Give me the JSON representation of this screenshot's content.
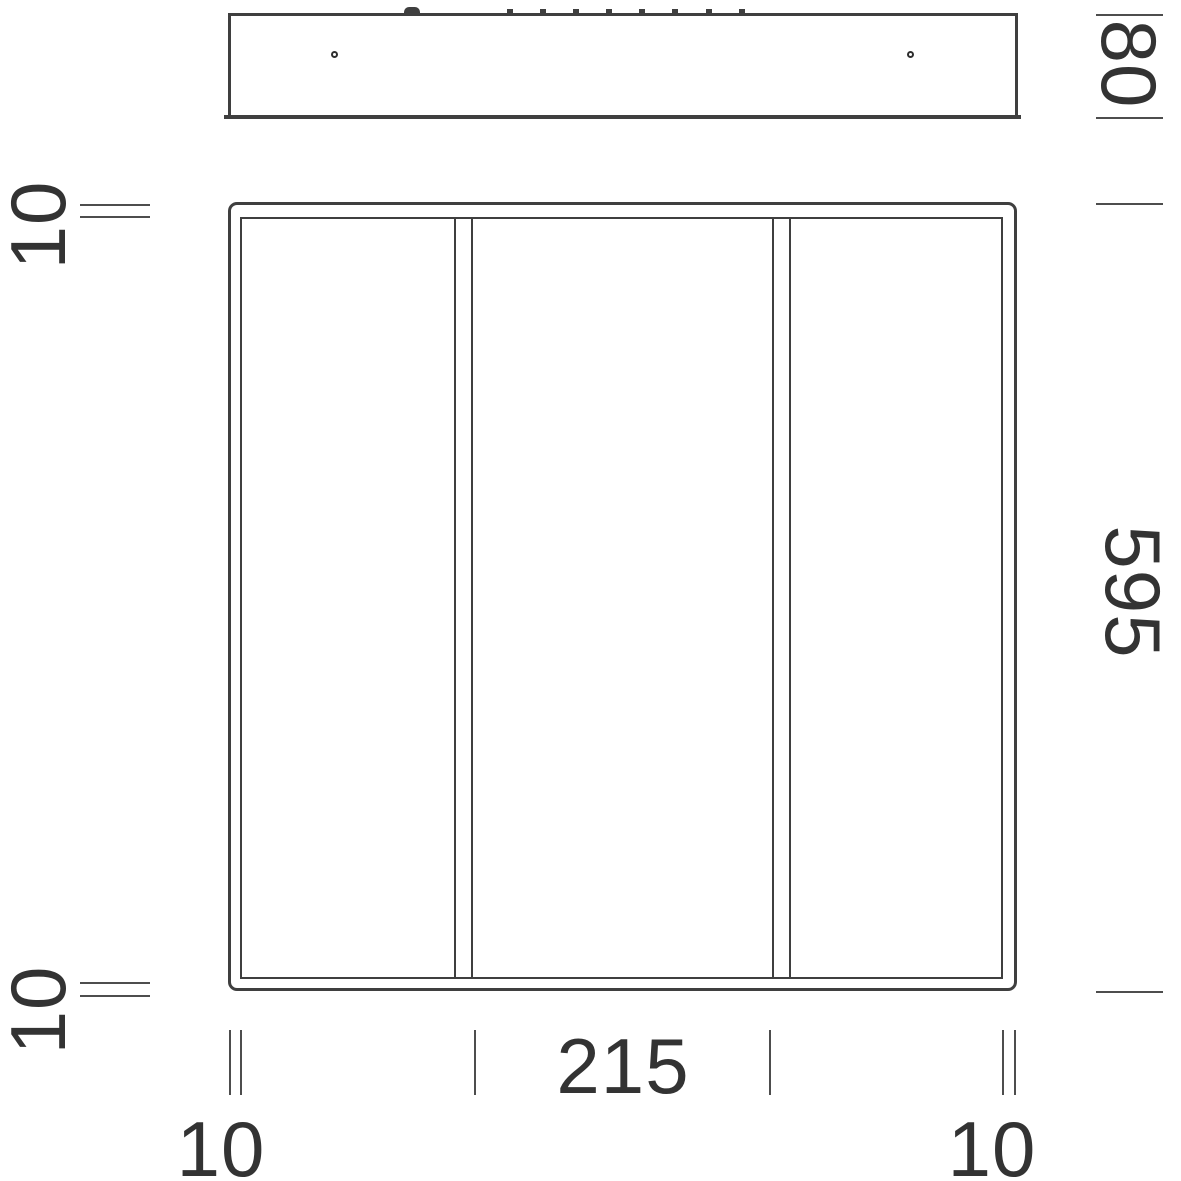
{
  "drawing": {
    "kind": "technical dimension drawing",
    "views": {
      "profile": "side profile of fixture",
      "front": "front face of panel"
    }
  },
  "dimensions": {
    "profile_height": "80",
    "panel_size": "595",
    "frame_top": "10",
    "frame_bottom": "10",
    "center_section_width": "215",
    "frame_left": "10",
    "frame_right": "10"
  },
  "icons": {
    "mounting_hole": "small outlined circle",
    "spring_clip": "rounded bump cut off at image top",
    "connector_pin": "small square tab cut off at image top"
  },
  "colors": {
    "line": "#3f3f3f",
    "tick": "#4d4d4d",
    "text": "#333333",
    "background": "#ffffff"
  }
}
